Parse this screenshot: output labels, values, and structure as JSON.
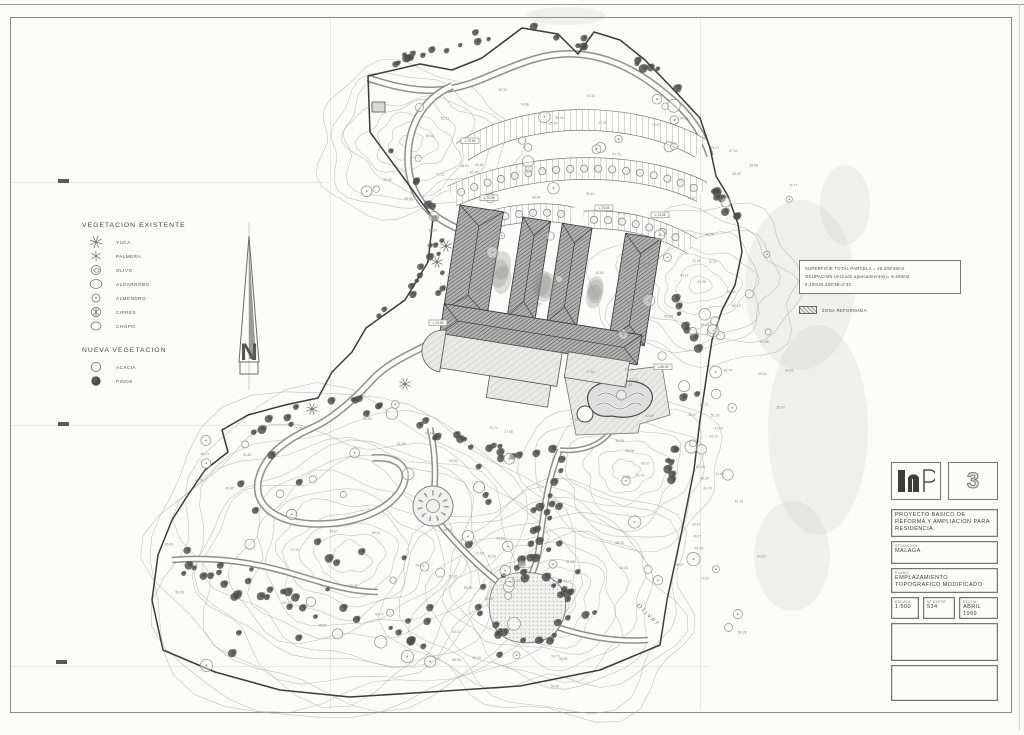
{
  "sheet": {
    "number": "3"
  },
  "legend": {
    "existing_title": "VEGETACION  EXISTENTE",
    "existing_items": [
      {
        "label": "YUCA",
        "symbol": "star-large"
      },
      {
        "label": "PALMERA",
        "symbol": "star-small"
      },
      {
        "label": "OLIVO",
        "symbol": "olive"
      },
      {
        "label": "ALGARROBO",
        "symbol": "ellipse-large"
      },
      {
        "label": "ALMENDRO",
        "symbol": "circle-dot"
      },
      {
        "label": "CIPRES",
        "symbol": "cypress"
      },
      {
        "label": "CHOPO",
        "symbol": "ellipse"
      }
    ],
    "new_title": "NUEVA  VEGETACION",
    "new_items": [
      {
        "label": "ACACIA",
        "symbol": "open-circle"
      },
      {
        "label": "PINOS",
        "symbol": "filled-circle"
      }
    ]
  },
  "notes": {
    "line1": "SUPERFICIE TOTAL PARCELA = 25.208'38m2",
    "line2": "OCUPACION (incluido aparcamientos)= 8.400m2",
    "line3": "8.400/25.208'38=0'33",
    "swatch_label": "ZONA REFORMADA"
  },
  "title_block": {
    "project": "PROYECTO BASICO DE REFORMA Y AMPLIACION PARA RESIDENCIA",
    "situacion_label": "SITUACION",
    "situacion": "MALAGA",
    "plano_label": "PLANO",
    "plano": "EMPLAZAMIENTO TOPOGRAFICO MODIFICADO",
    "escala_label": "ESCALA",
    "escala": "1:500",
    "expte_label": "Nº EXPTE",
    "expte": "534",
    "fecha_label": "FECHA",
    "fecha": "ABRIL 1999"
  },
  "map": {
    "seed": 7,
    "colors": {
      "ink": "#3c3c3c",
      "contour": "#aca89f",
      "pine": "#4d4d4d",
      "road": "#8f8f8c"
    },
    "boundary": "M368 76 L370 132 L433 218 L428 262 L405 300 L366 328 L352 352 L332 372 L318 398 L285 405 L248 415 L222 430 L228 452 L205 470 L188 495 L172 520 L158 555 L152 600 L163 650 L215 672 L280 690 L350 697 L430 692 L520 686 L600 670 L660 645 L667 600 L680 540 L694 470 L700 420 L706 380 L712 340 L722 310 L735 285 L742 252 L738 224 L728 196 L716 176 L710 148 L700 118 L672 88 L645 60 L620 40 L594 32 L578 54 L558 34 L522 28 L482 58 L452 70 L420 64 Z",
    "roads": [
      {
        "d": "M368 78 C420 96 450 92 480 80 C510 68 540 52 575 54 C610 56 640 72 668 96 C690 114 702 132 710 156",
        "w": 6
      },
      {
        "d": "M452 86 C420 100 408 130 408 158 C408 186 420 208 445 222 C452 226 458 229 463 231",
        "w": 6
      },
      {
        "d": "M463 231 C470 262 466 300 452 332",
        "w": 5
      },
      {
        "d": "M452 332 C420 350 390 360 372 380 C350 404 330 420 312 428 C280 442 262 460 258 482 C254 508 280 524 318 524 C356 524 390 510 402 488 C412 468 398 456 372 458",
        "w": 6
      },
      {
        "d": "M430 428 C436 454 436 482 433 498",
        "w": 5
      },
      {
        "d": "M440 524 C458 546 478 566 498 582",
        "w": 5
      },
      {
        "d": "M554 626 C588 638 620 642 648 640",
        "w": 5
      },
      {
        "d": "M172 560 C220 556 262 564 300 576 C330 585 352 592 378 592",
        "w": 5
      },
      {
        "d": "M560 450 C548 478 544 510 540 540 C538 560 534 572 528 580",
        "w": 5
      },
      {
        "d": "M610 432 C600 446 580 452 560 450",
        "w": 4
      }
    ],
    "parking": [
      {
        "d": "M462 152 C520 112 630 108 700 148",
        "w": 20,
        "trees": false
      },
      {
        "d": "M452 196 C535 158 645 162 702 192",
        "w": 21,
        "trees": true
      },
      {
        "d": "M482 222 C515 212 548 210 572 216",
        "w": 17,
        "trees": true
      },
      {
        "d": "M584 220 C625 218 662 228 692 246",
        "w": 17,
        "trees": true
      }
    ],
    "building": {
      "origin": [
        460,
        205
      ],
      "angle": 9,
      "wings": [
        [
          0,
          0,
          44,
          106
        ],
        [
          64,
          2,
          28,
          100
        ],
        [
          104,
          2,
          30,
          100
        ],
        [
          168,
          2,
          36,
          108
        ]
      ],
      "spine": [
        0,
        100,
        200,
        30
      ],
      "annexes": [
        [
          6,
          130,
          118,
          34
        ],
        [
          56,
          164,
          62,
          22
        ],
        [
          130,
          128,
          62,
          26
        ]
      ],
      "apse": [
        6,
        147,
        21
      ],
      "courtyards": [
        [
          52,
          58,
          9,
          26
        ],
        [
          95,
          60,
          9,
          24
        ],
        [
          148,
          60,
          8,
          22
        ]
      ]
    },
    "pool": {
      "platform": "M565 378 L662 366 L670 415 L640 424 L638 433 L576 435 Z",
      "water": "M588 402 C585 388 600 380 618 382 C640 378 655 388 652 400 C648 414 630 420 612 416 C598 418 590 412 588 402 Z",
      "waves": [
        "M598 396 q8 -6 16 0 q8 6 16 0 q8 -6 14 0",
        "M596 406 q8 -6 16 0 q8 6 16 0 q8 -6 14 0"
      ],
      "jacuzzi": [
        585,
        414,
        8
      ]
    },
    "roundabout": [
      433,
      506,
      20
    ],
    "plaza": {
      "d": "M500 578 C520 568 550 572 560 586 C570 598 566 622 554 634 C540 646 510 646 498 632 C486 618 486 590 500 578 Z"
    },
    "contour_families": [
      [
        350,
        558,
        18,
        190,
        15
      ],
      [
        548,
        600,
        14,
        135,
        11
      ],
      [
        412,
        142,
        10,
        88,
        8
      ],
      [
        700,
        285,
        10,
        92,
        8
      ],
      [
        625,
        470,
        12,
        88,
        7
      ]
    ],
    "pine_paths": [
      {
        "pts": [
          [
            378,
            62
          ],
          [
            430,
            50
          ],
          [
            480,
            36
          ],
          [
            530,
            30
          ],
          [
            580,
            42
          ],
          [
            625,
            50
          ],
          [
            660,
            74
          ],
          [
            695,
            112
          ]
        ],
        "n": 26,
        "s": 6
      },
      {
        "pts": [
          [
            383,
            142
          ],
          [
            410,
            172
          ],
          [
            430,
            212
          ],
          [
            428,
            258
          ],
          [
            408,
            296
          ],
          [
            372,
            324
          ]
        ],
        "n": 15,
        "s": 5
      },
      {
        "pts": [
          [
            252,
            430
          ],
          [
            300,
            414
          ],
          [
            352,
            406
          ],
          [
            408,
            420
          ],
          [
            452,
            440
          ],
          [
            500,
            452
          ],
          [
            548,
            452
          ]
        ],
        "n": 30,
        "s": 9
      },
      {
        "pts": [
          [
            560,
            452
          ],
          [
            548,
            488
          ],
          [
            540,
            520
          ],
          [
            532,
            556
          ],
          [
            520,
            580
          ]
        ],
        "n": 18,
        "s": 8
      },
      {
        "pts": [
          [
            178,
            562
          ],
          [
            220,
            580
          ],
          [
            268,
            596
          ],
          [
            320,
            610
          ],
          [
            380,
            624
          ],
          [
            440,
            640
          ]
        ],
        "n": 22,
        "s": 11
      },
      {
        "pts": [
          [
            682,
            298
          ],
          [
            697,
            348
          ],
          [
            690,
            400
          ],
          [
            676,
            452
          ],
          [
            668,
            500
          ]
        ],
        "n": 16,
        "s": 7
      },
      {
        "pts": [
          [
            438,
            238
          ],
          [
            444,
            270
          ],
          [
            436,
            300
          ]
        ],
        "n": 6,
        "s": 4
      },
      {
        "pts": [
          [
            700,
            178
          ],
          [
            720,
            200
          ],
          [
            735,
            226
          ]
        ],
        "n": 8,
        "s": 8
      }
    ],
    "pine_ring": [
      524,
      606,
      44,
      24,
      7
    ],
    "pine_rect": [
      185,
      445,
      410,
      220,
      36
    ],
    "tree_rects": [
      [
        360,
        90,
        320,
        110,
        20
      ],
      [
        430,
        200,
        300,
        180,
        12
      ],
      [
        200,
        400,
        430,
        280,
        34
      ],
      [
        620,
        360,
        130,
        280,
        16
      ],
      [
        700,
        150,
        90,
        240,
        10
      ]
    ],
    "spot_rects": [
      [
        150,
        420,
        560,
        270,
        46
      ],
      [
        380,
        75,
        340,
        125,
        18
      ],
      [
        420,
        190,
        310,
        210,
        22
      ],
      [
        610,
        360,
        150,
        300,
        20
      ],
      [
        690,
        140,
        100,
        270,
        14
      ]
    ],
    "spot_range": [
      40,
      76
    ],
    "yuccas": [
      [
        437,
        262
      ],
      [
        446,
        246
      ],
      [
        405,
        384
      ],
      [
        312,
        409
      ]
    ],
    "boxed_labels": [
      [
        470,
        142,
        "L-70.50"
      ],
      [
        489,
        199,
        "L-75.08"
      ],
      [
        604,
        209,
        "L-75.08"
      ],
      [
        660,
        216,
        "L-74.08"
      ],
      [
        438,
        324,
        "L-73.08"
      ],
      [
        663,
        368,
        "L-68.40"
      ]
    ],
    "hut": [
      372,
      102,
      13,
      10
    ],
    "labels": [
      {
        "text": "Olivar",
        "x": 636,
        "y": 606,
        "rot": 42
      }
    ],
    "smudges": [
      [
        800,
        285,
        55,
        85
      ],
      [
        818,
        430,
        50,
        105
      ],
      [
        792,
        556,
        38,
        55
      ],
      [
        566,
        16,
        40,
        9
      ],
      [
        845,
        205,
        25,
        40
      ]
    ]
  }
}
